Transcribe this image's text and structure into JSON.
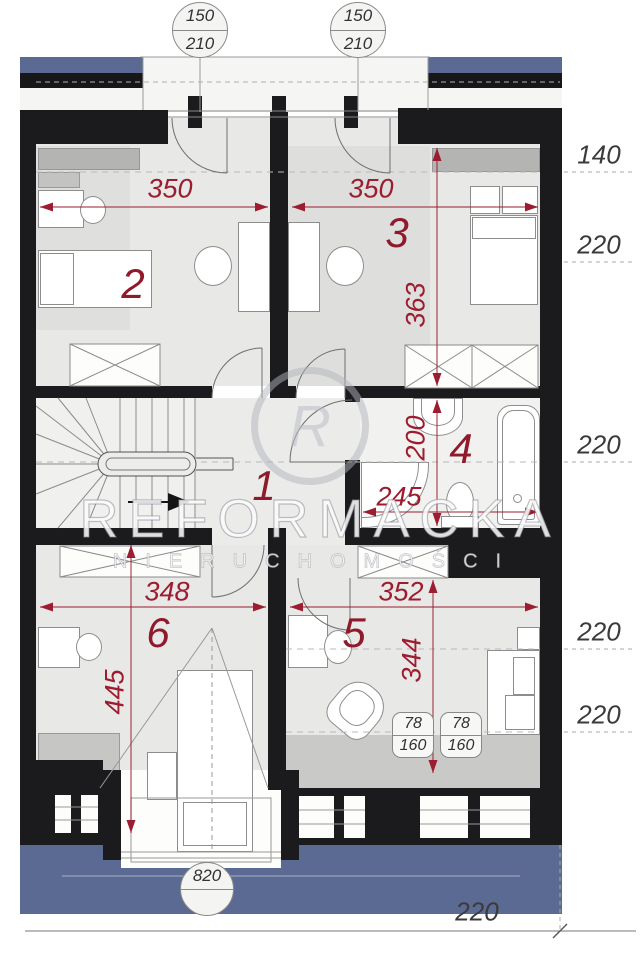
{
  "watermark": {
    "brand": "REFORMACKA",
    "subtitle": "NIERUCHOMOŚCI",
    "monogram": "R"
  },
  "door_markers": [
    {
      "width": "150",
      "height": "210"
    },
    {
      "width": "150",
      "height": "210"
    }
  ],
  "front_marker": {
    "width": "820"
  },
  "room_numbers": {
    "hall": "1",
    "bedroom_top_left": "2",
    "bedroom_top_right": "3",
    "bathroom": "4",
    "bedroom_bottom_right": "5",
    "bedroom_bottom_left": "6"
  },
  "dimensions": {
    "room2_width": "350",
    "room3_width": "350",
    "room3_depth": "363",
    "bath_depth": "200",
    "bath_width": "245",
    "room6_width": "348",
    "room5_width": "352",
    "room5_depth": "344",
    "room6_depth": "445"
  },
  "elevation_labels": {
    "right": [
      "140",
      "220",
      "220",
      "220",
      "220"
    ],
    "bottom_right": "220"
  },
  "skylight_markers": [
    {
      "width": "78",
      "height": "160"
    },
    {
      "width": "78",
      "height": "160"
    }
  ],
  "colors": {
    "wall": "#1b1b1e",
    "dimension_red": "#9b1d2f",
    "roof_blue": "#5b6a93",
    "floor": "#e8e8e7",
    "label_gray": "#3b3b3b"
  }
}
